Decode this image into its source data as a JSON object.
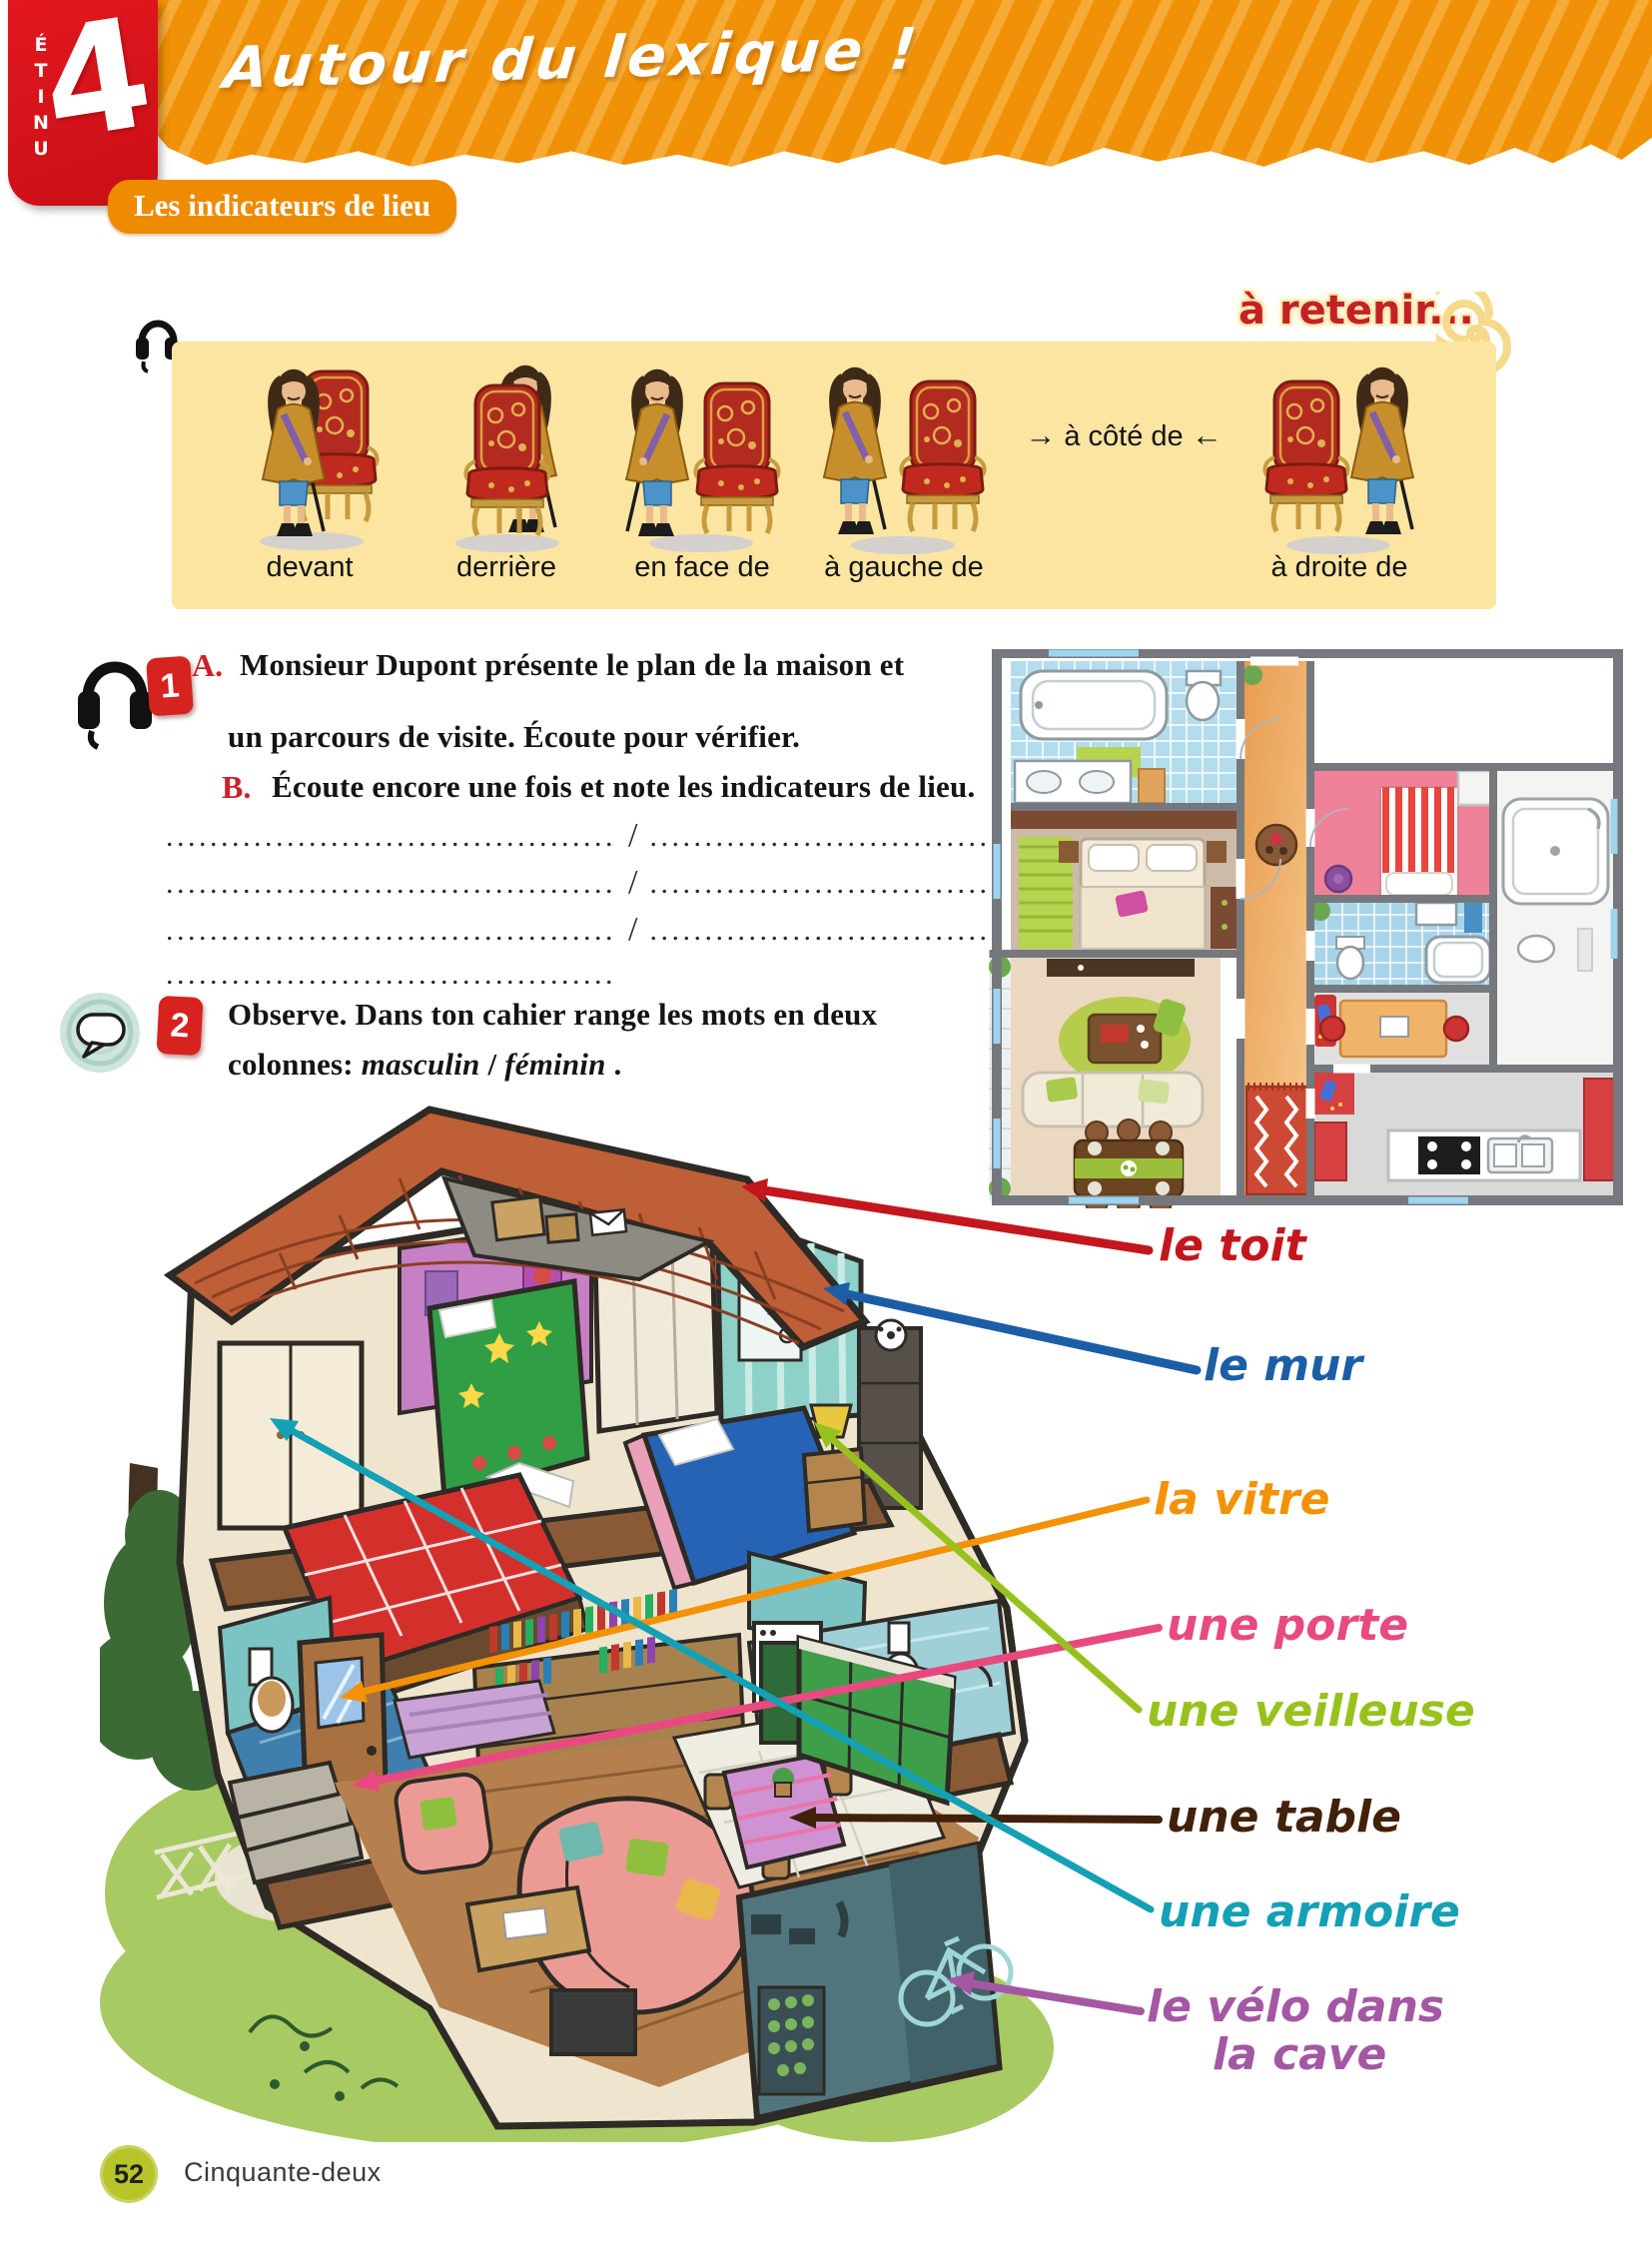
{
  "unit": {
    "letters": [
      "U",
      "N",
      "I",
      "T",
      "É"
    ],
    "number": "4"
  },
  "header": {
    "title": "Autour du lexique !"
  },
  "section": {
    "tag": "Les indicateurs de lieu",
    "reminder": "à retenir..."
  },
  "vocab_panel": {
    "items": [
      "devant",
      "derrière",
      "en face de",
      "à gauche de",
      "à droite de"
    ],
    "middle": {
      "left_arrow": "→",
      "text": "à côté de",
      "right_arrow": "←"
    }
  },
  "exercise1": {
    "number": "1",
    "a_label": "A.",
    "a_line1": "Monsieur Dupont présente le plan de la maison et",
    "a_line2": "un parcours de visite. Écoute pour vérifier.",
    "b_label": "B.",
    "b_text": "Écoute encore une fois et note les indicateurs de lieu.",
    "answer_rows": [
      {
        "left": ".........................................",
        "slash": "/",
        "right": "........................................."
      },
      {
        "left": ".........................................",
        "slash": "/",
        "right": "........................................."
      },
      {
        "left": ".........................................",
        "slash": "/",
        "right": "........................................."
      },
      {
        "left": "........................................."
      }
    ]
  },
  "exercise2": {
    "number": "2",
    "line1": "Observe. Dans ton cahier range les mots en deux",
    "line2_prefix": "colonnes: ",
    "line2_word1": "masculin",
    "line2_sep": " / ",
    "line2_word2": "féminin",
    "line2_end": " ."
  },
  "house_labels": [
    {
      "text": "le toit",
      "color": "#c4161d"
    },
    {
      "text": "le mur",
      "color": "#1b5ea6"
    },
    {
      "text": "la vitre",
      "color": "#f39207"
    },
    {
      "text": "une porte",
      "color": "#e84a7f"
    },
    {
      "text": "une veilleuse",
      "color": "#97c21e"
    },
    {
      "text": "une table",
      "color": "#42210b"
    },
    {
      "text": "une armoire",
      "color": "#14a0b5"
    },
    {
      "text": "le vélo dans",
      "color": "#a457a3"
    },
    {
      "text": "la cave",
      "color": "#a457a3"
    }
  ],
  "footer": {
    "page_number": "52",
    "page_word": "Cinquante-deux"
  }
}
